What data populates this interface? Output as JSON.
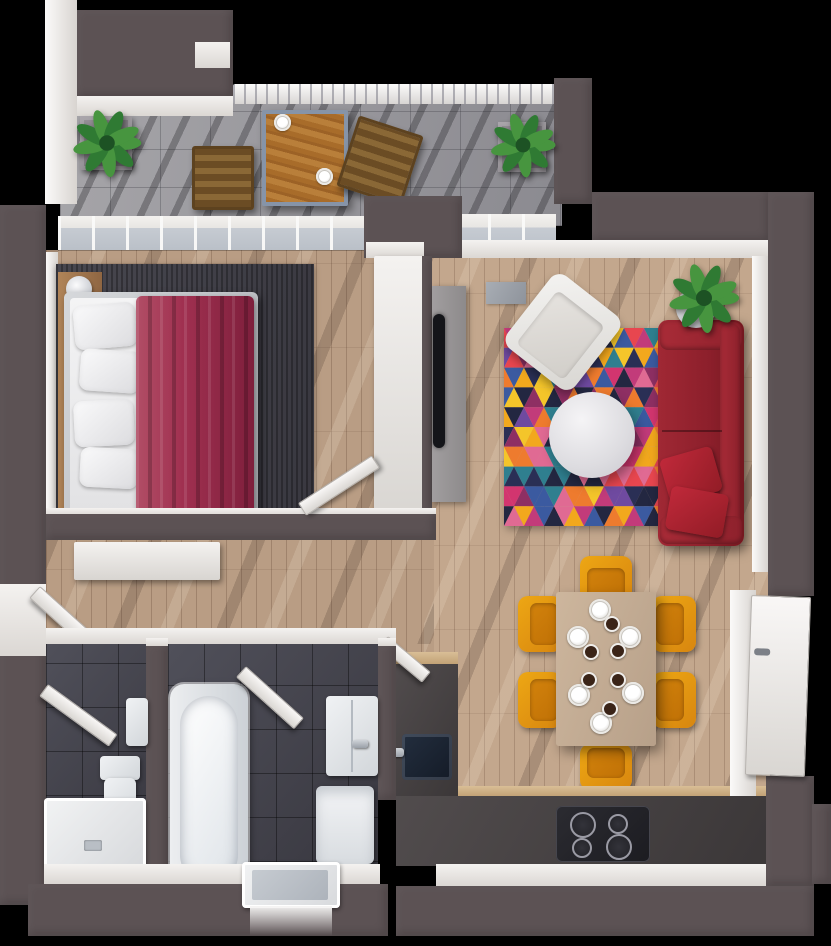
{
  "scene": {
    "type": "3d-rendered-floor-plan-top-view",
    "subject": "one-bedroom apartment with balcony",
    "background": "#000000"
  },
  "palette": {
    "wall_dark": "#5c5254",
    "wall_white": "#f4f2f0",
    "wood_floor": "#b99d84",
    "wood_floor_light": "#c3a78d",
    "balcony_stone": "#8b8a90",
    "slate_floor": "#36353d",
    "rug_dark": "#393840",
    "bed_blanket": "#a03050",
    "sofa_red": "#8c1f2b",
    "pillow_red": "#c0293a",
    "chair_yellow": "#eda714",
    "chair_seat": "#d2820c",
    "table_beige": "#b7a089",
    "counter_dark": "#3b3738",
    "counter_edge_wood": "#c2a276",
    "cooktop": "#1c1c21",
    "fixture_white": "#f0f2f4",
    "glass": "#c6cbd2",
    "tv_black": "#141519",
    "tv_panel": "#a19e9f",
    "door_white": "#f9f7f6",
    "wood_brown": "#8a6836",
    "wood_table": "#a86c2a",
    "plant_green": "#2f7a33",
    "plant_green_light": "#47953f",
    "plant_green_dark": "#1d5224"
  },
  "rug": {
    "pattern": "triangles",
    "rows": 10,
    "cols": 17,
    "colors": [
      "#e8464f",
      "#ee7b2e",
      "#f2a81d",
      "#f4c52a",
      "#d2356f",
      "#c23b7a",
      "#8e2f63",
      "#6f4aa0",
      "#3b5aa0",
      "#2a2f55",
      "#2f7f8f",
      "#232741",
      "#e06a93"
    ]
  },
  "rooms": [
    {
      "name": "balcony",
      "floor": "stone-tile",
      "items": [
        "plant-pot",
        "wooden-chair",
        "wooden-table",
        "wooden-lounge-chair",
        "plant-pot",
        "railing"
      ]
    },
    {
      "name": "bedroom",
      "floor": "wood-plank",
      "items": [
        "double-bed",
        "red-blanket",
        "pillows",
        "dark-rug",
        "headboard-bench",
        "bedside-lamp",
        "bedside-lamp",
        "wardrobe",
        "door"
      ]
    },
    {
      "name": "living-room",
      "floor": "wood-plank",
      "items": [
        "tv-panel",
        "tv",
        "triangle-rug",
        "white-armchair",
        "round-coffee-table",
        "red-sofa",
        "red-cushions",
        "potted-plant",
        "floor-mat"
      ]
    },
    {
      "name": "hallway",
      "floor": "wood-plank",
      "items": [
        "white-sideboard",
        "doors"
      ]
    },
    {
      "name": "wc",
      "floor": "slate-tile",
      "items": [
        "toilet",
        "shower-tray",
        "wall-cabinet",
        "door"
      ]
    },
    {
      "name": "bathroom",
      "floor": "slate-tile",
      "items": [
        "bathtub",
        "sink-vanity",
        "washing-machine",
        "shower-tray",
        "door"
      ]
    },
    {
      "name": "kitchen-dining",
      "floor": "wood-plank",
      "items": [
        "dining-table",
        "six-yellow-chairs",
        "place-settings",
        "kitchen-counter",
        "cooktop",
        "sink",
        "tall-cabinet",
        "fridge-door"
      ]
    }
  ],
  "dining": {
    "chairs": 6,
    "place_settings": 6,
    "cups": 6
  },
  "cooktop": {
    "burners": 4
  },
  "balcony_table": {
    "plates": 2
  }
}
